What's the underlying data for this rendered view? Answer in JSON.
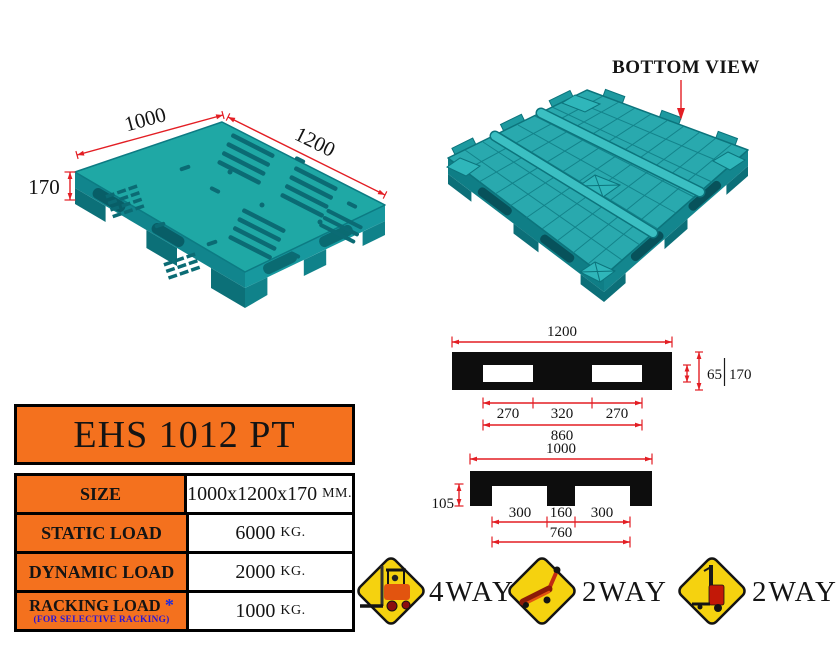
{
  "colors": {
    "pallet_teal": "#1FA8A5",
    "pallet_teal_dark": "#0E7880",
    "orange": "#F4711E",
    "dimension_red": "#E31E24",
    "sign_yellow": "#F5D20F",
    "note_blue": "#2B16D6"
  },
  "top_view": {
    "width_mm": "1000",
    "length_mm": "1200",
    "height_mm": "170"
  },
  "bottom_view": {
    "label": "BOTTOM VIEW"
  },
  "profile_1200": {
    "overall": "1200",
    "slot_height": "65",
    "overall_height": "170",
    "segments": [
      "270",
      "320",
      "270"
    ],
    "inner_span": "860"
  },
  "profile_1000": {
    "overall": "1000",
    "foot_height": "105",
    "segments": [
      "300",
      "160",
      "300"
    ],
    "inner_span": "760"
  },
  "spec_table": {
    "title": "EHS 1012 PT",
    "rows": [
      {
        "label": "SIZE",
        "value": "1000x1200x170",
        "unit": "MM."
      },
      {
        "label": "STATIC LOAD",
        "value": "6000",
        "unit": "KG."
      },
      {
        "label": "DYNAMIC LOAD",
        "value": "2000",
        "unit": "KG."
      },
      {
        "label": "RACKING LOAD",
        "asterisk": "*",
        "note": "(FOR SELECTIVE RACKING)",
        "value": "1000",
        "unit": "KG."
      }
    ]
  },
  "entry_signs": [
    {
      "icon": "forklift",
      "label": "4WAY"
    },
    {
      "icon": "hand-pallet-truck",
      "label": "2WAY"
    },
    {
      "icon": "pallet-stacker",
      "label": "2WAY"
    }
  ]
}
